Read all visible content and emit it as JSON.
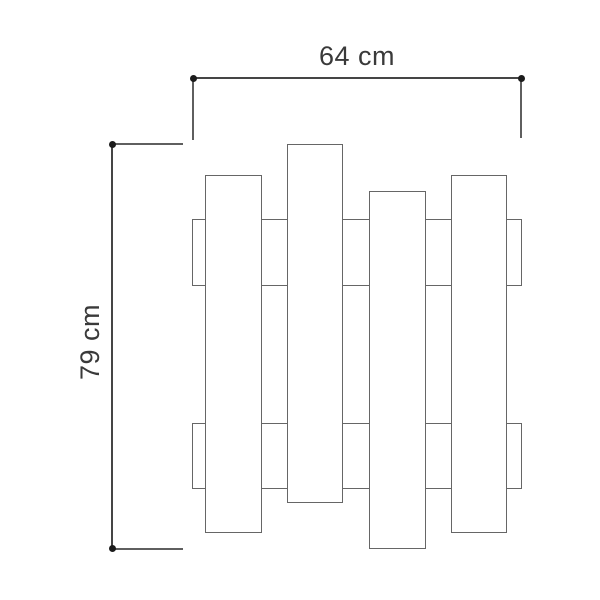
{
  "drawing": {
    "type": "technical-dimension-drawing",
    "width_label": "64 cm",
    "height_label": "79 cm",
    "figure": {
      "planks_count": 4,
      "rails_count": 2
    },
    "colors": {
      "background": "#ffffff",
      "figure_line": "#666666",
      "dimension_line": "#454545",
      "extension_line": "#5f5f5f",
      "dot": "#1c1c1c",
      "text": "#3a3a3a"
    }
  }
}
